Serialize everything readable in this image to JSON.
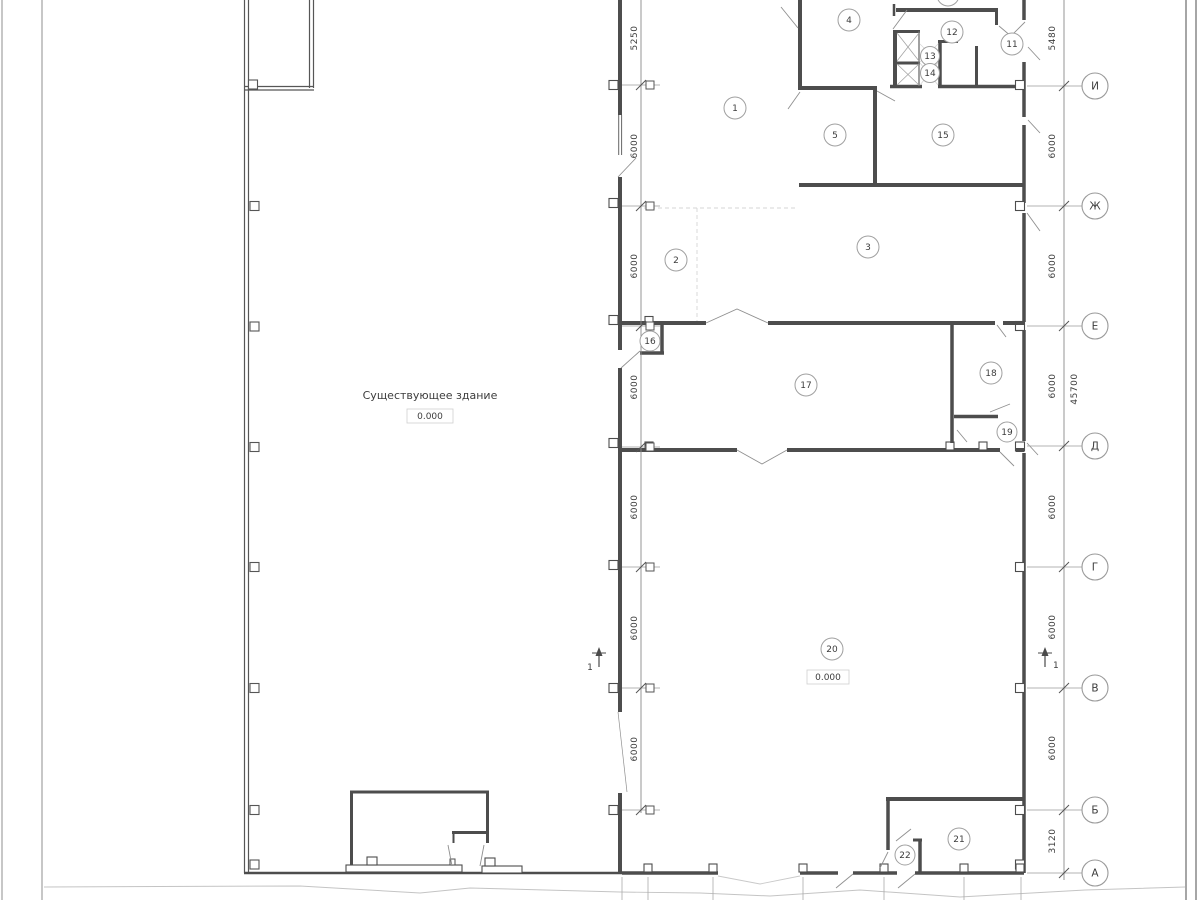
{
  "drawing": {
    "existing_building_label": "Существующее здание",
    "existing_building_level": "0.000",
    "hall_level": "0.000"
  },
  "rooms": [
    "1",
    "2",
    "3",
    "4",
    "5",
    "11",
    "12",
    "13",
    "14",
    "15",
    "16",
    "17",
    "18",
    "19",
    "20",
    "21",
    "22"
  ],
  "axes": [
    "И",
    "Ж",
    "Е",
    "Д",
    "Г",
    "В",
    "Б",
    "А"
  ],
  "dims": {
    "left": [
      "5250",
      "6000",
      "6000",
      "6000",
      "6000",
      "6000",
      "6000"
    ],
    "right": [
      "5480",
      "6000",
      "6000",
      "6000",
      "6000",
      "6000",
      "6000",
      "3120"
    ],
    "total": "45700"
  },
  "section": {
    "label": "1"
  }
}
